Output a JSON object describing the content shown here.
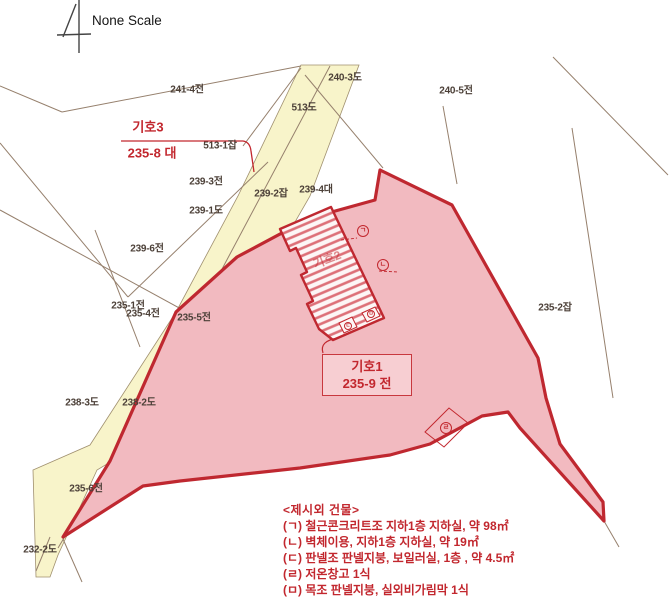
{
  "title": {
    "scale_note": "None Scale"
  },
  "colors": {
    "road_fill": "#f8f4ca",
    "road_edge": "#a0906f",
    "parcel_fill": "#f2bac0",
    "parcel_border": "#bf2830",
    "red_text": "#c2272e",
    "boundary_line": "#96806d",
    "label_dark": "#4c4038"
  },
  "map": {
    "north_arrow_icon": "north-arrow",
    "parcel_labels": [
      {
        "text": "241-4전",
        "x": 187,
        "y": 88
      },
      {
        "text": "240-3도",
        "x": 345,
        "y": 76
      },
      {
        "text": "240-5전",
        "x": 456,
        "y": 89
      },
      {
        "text": "513도",
        "x": 304,
        "y": 106
      },
      {
        "text": "513-1잡",
        "x": 220,
        "y": 144
      },
      {
        "text": "239-3전",
        "x": 206,
        "y": 180
      },
      {
        "text": "239-1도",
        "x": 206,
        "y": 209
      },
      {
        "text": "239-2잡",
        "x": 271,
        "y": 192
      },
      {
        "text": "239-4대",
        "x": 316,
        "y": 188
      },
      {
        "text": "239-6전",
        "x": 147,
        "y": 247
      },
      {
        "text": "235-1전",
        "x": 128,
        "y": 304
      },
      {
        "text": "235-4전",
        "x": 143,
        "y": 312
      },
      {
        "text": "235-5전",
        "x": 194,
        "y": 316
      },
      {
        "text": "238-3도",
        "x": 82,
        "y": 401
      },
      {
        "text": "238-2도",
        "x": 139,
        "y": 401
      },
      {
        "text": "235-6전",
        "x": 86,
        "y": 487
      },
      {
        "text": "232-2도",
        "x": 40,
        "y": 548
      },
      {
        "text": "235-2잡",
        "x": 555,
        "y": 306
      }
    ],
    "subject3": {
      "name": "기호3",
      "parcel": "235-8 대"
    },
    "subject1": {
      "name": "기호1",
      "parcel": "235-9 전"
    },
    "building2_label": "기호2",
    "markers": [
      {
        "letter": "ㄱ",
        "x": 363,
        "y": 231,
        "tiny": false
      },
      {
        "letter": "ㄴ",
        "x": 383,
        "y": 265,
        "tiny": false
      },
      {
        "letter": "ㄷ",
        "x": 348,
        "y": 326,
        "tiny": true
      },
      {
        "letter": "ㅁ",
        "x": 371,
        "y": 314,
        "tiny": true
      },
      {
        "letter": "ㄹ",
        "x": 446,
        "y": 428,
        "tiny": false
      }
    ]
  },
  "legend": {
    "title": "<제시외 건물>",
    "items": [
      "(ㄱ) 철근콘크리트조 지하1층 지하실, 약 98㎡",
      "(ㄴ) 벽체이용, 지하1층 지하실, 약 19㎡",
      "(ㄷ) 판넬조 판넬지붕, 보일러실, 1층 , 약 4.5㎡",
      "(ㄹ) 저온창고 1식",
      "(ㅁ) 목조 판넬지붕, 실외비가림막 1식"
    ]
  }
}
